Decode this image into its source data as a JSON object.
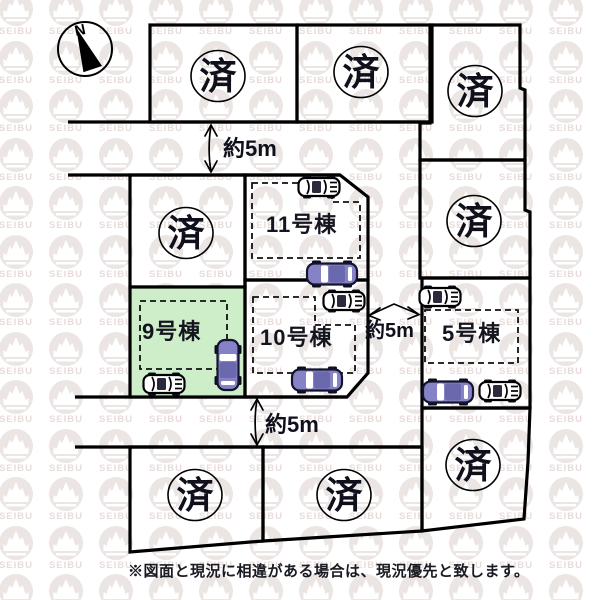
{
  "plan": {
    "compass_label": "N",
    "sold_mark": "済",
    "buildings": {
      "b5": {
        "label": "5号棟"
      },
      "b9": {
        "label": "9号棟",
        "highlighted": true
      },
      "b10": {
        "label": "10号棟"
      },
      "b11": {
        "label": "11号棟"
      }
    },
    "roads": {
      "north": {
        "label": "約5m"
      },
      "east": {
        "label": "約5m"
      },
      "south": {
        "label": "約5m"
      }
    },
    "note": "※図面と現況に相違がある場合は、現況優先と致します。",
    "watermark_text": "SEIBU",
    "colors": {
      "highlight_green": "#cdeec9",
      "car_body_purple": "#8583c5",
      "car_roof_purple": "#6b69ae",
      "line_black": "#000000"
    }
  }
}
